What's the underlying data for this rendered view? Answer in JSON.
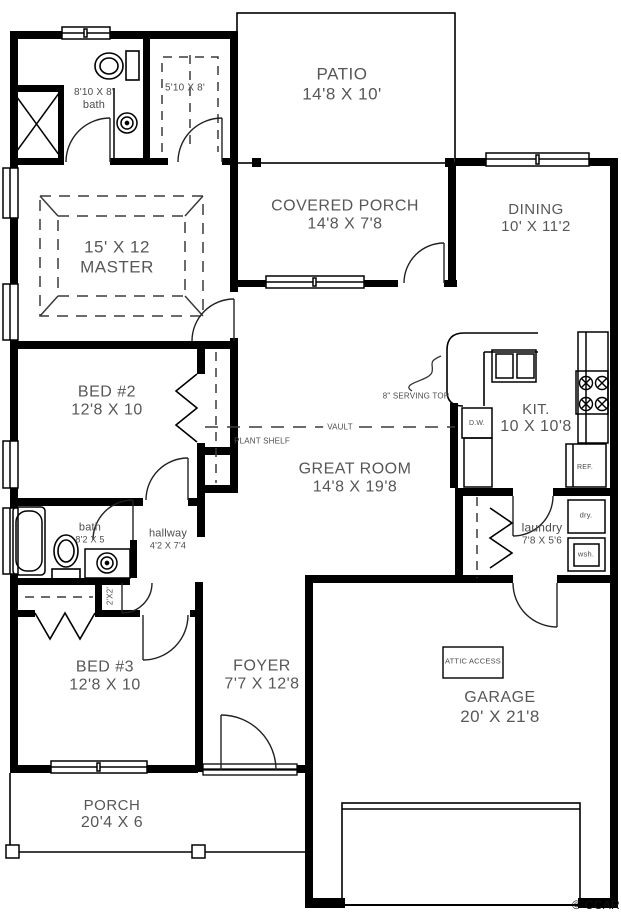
{
  "meta": {
    "title": "Single-story house floor plan",
    "credit": "© CCAR"
  },
  "colors": {
    "wall": "#000000",
    "label": "#575757",
    "background": "#ffffff"
  },
  "rooms": [
    {
      "id": "patio",
      "name": "PATIO",
      "dims": "14'8 X 10'"
    },
    {
      "id": "covered-porch",
      "name": "COVERED PORCH",
      "dims": "14'8 X 7'8"
    },
    {
      "id": "dining",
      "name": "DINING",
      "dims": "10' X 11'2"
    },
    {
      "id": "master-bath",
      "name": "bath",
      "dims": "8'10 X 8'"
    },
    {
      "id": "master-closet",
      "name": "",
      "dims": "5'10 X 8'"
    },
    {
      "id": "master",
      "name": "MASTER",
      "dims": "15' X 12"
    },
    {
      "id": "bed-2",
      "name": "BED #2",
      "dims": "12'8 X 10"
    },
    {
      "id": "great-room",
      "name": "GREAT ROOM",
      "dims": "14'8 X 19'8"
    },
    {
      "id": "kitchen",
      "name": "KIT.",
      "dims": "10 X 10'8"
    },
    {
      "id": "hall-bath",
      "name": "bath",
      "dims": "8'2 X 5"
    },
    {
      "id": "hallway",
      "name": "hallway",
      "dims": "4'2 X 7'4"
    },
    {
      "id": "laundry",
      "name": "laundry",
      "dims": "7'8 X 5'6"
    },
    {
      "id": "bed-3",
      "name": "BED #3",
      "dims": "12'8 X 10"
    },
    {
      "id": "foyer",
      "name": "FOYER",
      "dims": "7'7 X 12'8"
    },
    {
      "id": "garage",
      "name": "GARAGE",
      "dims": "20' X 21'8"
    },
    {
      "id": "porch",
      "name": "PORCH",
      "dims": "20'4 X 6"
    }
  ],
  "annotations": {
    "plant_shelf": "PLANT SHELF",
    "vault": "VAULT",
    "serving_top": "8\" SERVING TOP",
    "dishwasher": "D.W.",
    "refrigerator": "REF.",
    "dryer": "dry.",
    "washer": "wsh.",
    "attic_access": "ATTIC ACCESS",
    "closet_2x2": "2'X2'",
    "credit": "© CCAR"
  }
}
